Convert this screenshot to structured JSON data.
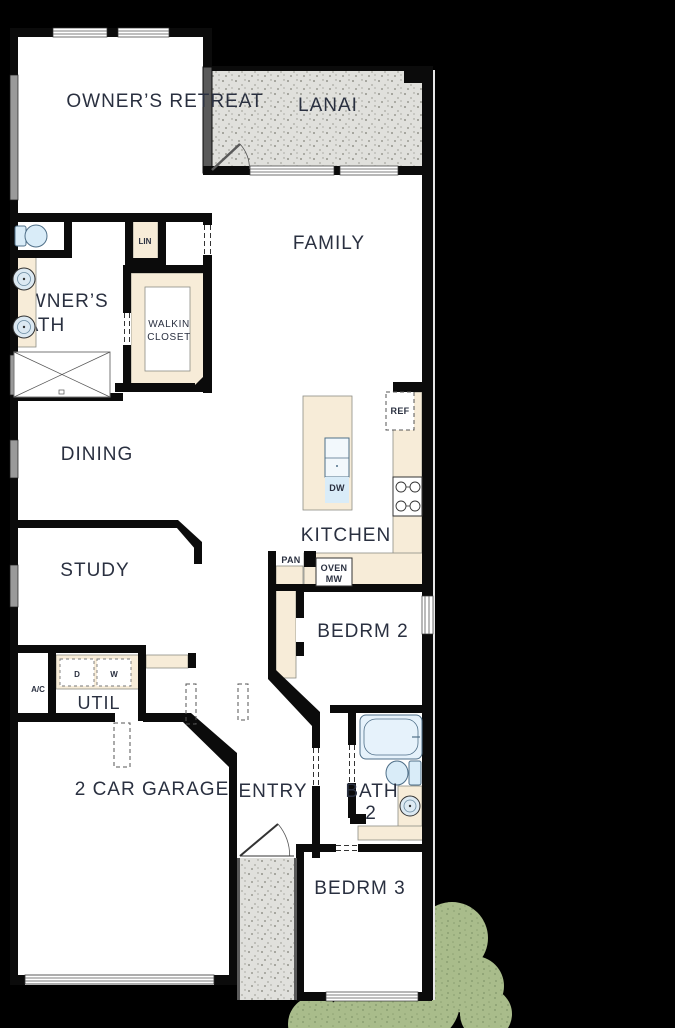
{
  "plan": {
    "rooms": {
      "owners_retreat": "OWNER’S RETREAT",
      "lanai": "LANAI",
      "family": "FAMILY",
      "owners_bath_line1": "OWNER’S",
      "owners_bath_line2": "BATH",
      "linen": "LIN",
      "walkin_line1": "WALKIN",
      "walkin_line2": "CLOSET",
      "dining": "DINING",
      "kitchen": "KITCHEN",
      "study": "STUDY",
      "bedroom2": "BEDRM 2",
      "utility": "UTIL",
      "garage": "2 CAR GARAGE",
      "entry": "ENTRY",
      "bath2_line1": "BATH",
      "bath2_line2": "2",
      "bedroom3": "BEDRM 3"
    },
    "labels": {
      "refrigerator": "REF",
      "dishwasher": "DW",
      "pantry": "PAN",
      "oven": "OVEN",
      "microwave": "MW",
      "dryer": "D",
      "washer": "W",
      "air_conditioner": "A/C"
    },
    "colors": {
      "background": "#000000",
      "floor": "#ffffff",
      "wall": "#0b0b0b",
      "outdoor_fill": "#e0e0dc",
      "outdoor_speckle": "#94948c",
      "cabinet_fill": "#f7ecd8",
      "cabinet_border": "#8d8d85",
      "fixture_fill": "#d9ecf8",
      "fixture_border": "#4f6f88",
      "label_text": "#2a3040",
      "shrub_fill": "#a9bc8b",
      "shrub_speckle": "#82966a",
      "screen_wall": "#5a5a5a"
    }
  }
}
